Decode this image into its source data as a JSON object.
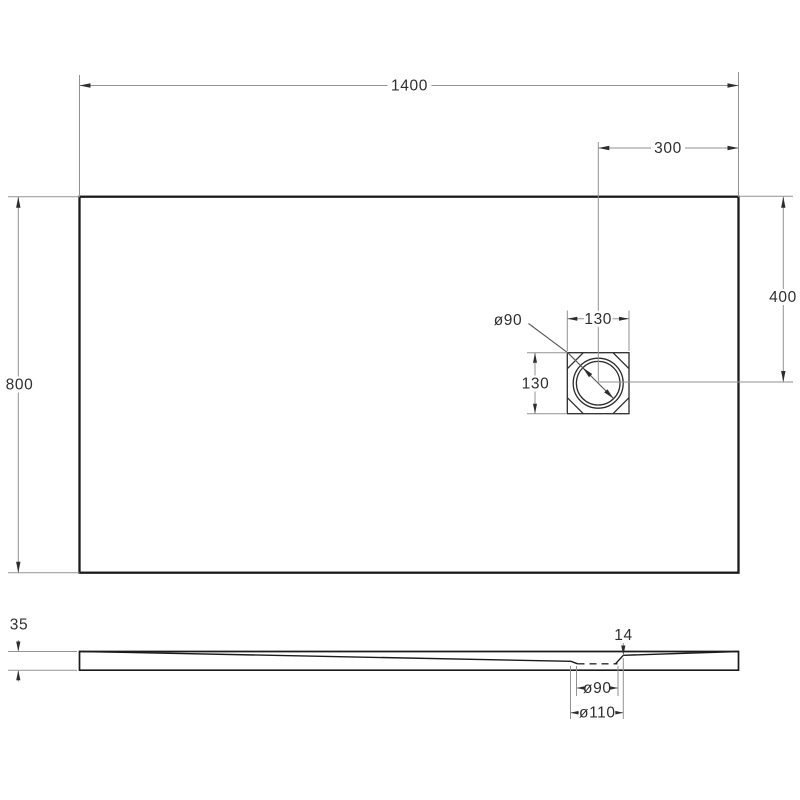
{
  "colors": {
    "background": "#ffffff",
    "outline": "#1b1b1b",
    "detail": "#2d2d2d",
    "thin": "#929292",
    "text": "#2f2f2f"
  },
  "top_view": {
    "length": "1400",
    "width": "800",
    "drain_offset_from_right": "300",
    "drain_offset_vertical": "400",
    "drain_box_width": "130",
    "drain_box_height": "130",
    "drain_diameter": "ø90"
  },
  "side_view": {
    "thickness": "35",
    "drain_lip_height": "14",
    "drain_hole_diameter": "ø90",
    "drain_recess_diameter": "ø110"
  }
}
